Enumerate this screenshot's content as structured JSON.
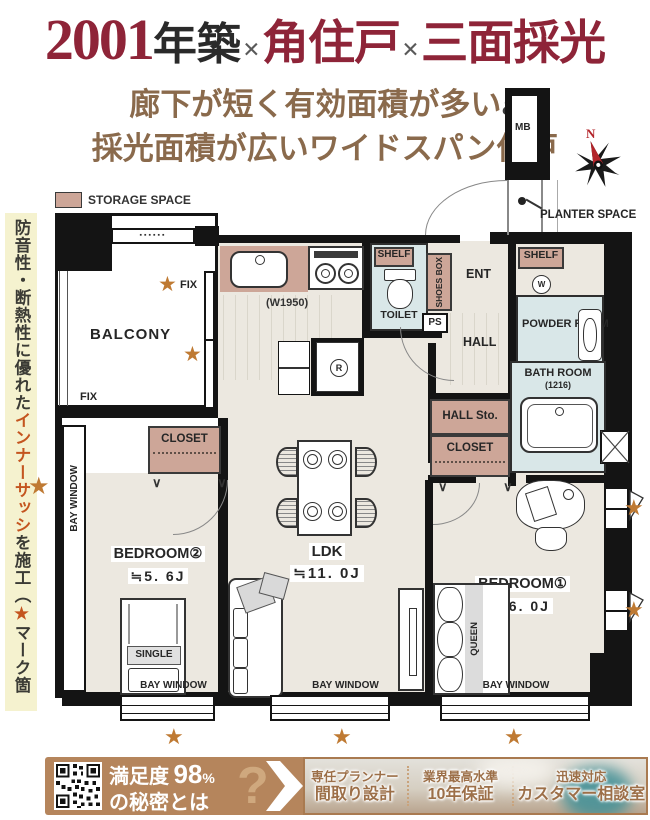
{
  "header": {
    "year": "2001",
    "built": "年築",
    "x1": "×",
    "corner_unit": "角住戸",
    "x2": "×",
    "three_sides": "三面採光"
  },
  "subtitle": {
    "line1": "廊下が短く有効面積が多い",
    "amp": "&",
    "line2": "採光面積が広いワイドスパン住戸"
  },
  "side_note": {
    "part1": "防音性・断熱性に優れた",
    "highlight": "インナーサッシ",
    "part2": "を施工（",
    "star": "★",
    "part3": "マーク箇所）"
  },
  "legend": {
    "storage_space": "STORAGE SPACE"
  },
  "compass": {
    "north": "N"
  },
  "plan": {
    "balcony": "BALCONY",
    "fix": "FIX",
    "bay_window": "BAY WINDOW",
    "closet": "CLOSET",
    "hall_sto": "HALL Sto.",
    "shelf": "SHELF",
    "shoes_box": "SHOES BOX",
    "toilet": "TOILET",
    "ps": "PS",
    "ent": "ENT",
    "hall": "HALL",
    "powder_room": "POWDER ROOM",
    "bath_room": "BATH ROOM",
    "bath_size": "(1216)",
    "ldk": "LDK",
    "ldk_size": "≒11. 0J",
    "bedroom1": "BEDROOM①",
    "bedroom1_size": "≒6. 0J",
    "bedroom2": "BEDROOM②",
    "bedroom2_size": "≒5. 6J",
    "single": "SINGLE",
    "queen": "QUEEN",
    "kitchen_width": "(W1950)",
    "fridge_r": "R",
    "washer_w": "W",
    "mb": "MB",
    "planter_space": "PLANTER SPACE",
    "star": "★",
    "v_mark": "∨ ∨"
  },
  "banner": {
    "prefix": "満足度",
    "number": "98",
    "percent": "%",
    "line2": "の秘密とは",
    "question": "?",
    "f1_top": "専任プランナー",
    "f1_bottom": "間取り設計",
    "f2_top": "業界最高水準",
    "f2_bottom": "10年保証",
    "f3_top": "迅速対応",
    "f3_bottom": "カスタマー相談室"
  },
  "colors": {
    "accent_red": "#8e2438",
    "subtitle_brown": "#8a6a4c",
    "note_bg": "#f5f2cf",
    "note_orange": "#c4551f",
    "storage_tan": "#cda698",
    "wet_blue": "#d9e7e8",
    "floor_beige": "#ece8e0",
    "star_orange": "#bf7a33",
    "banner_brown": "#b5855c",
    "banner_text_brown": "#9c6f48",
    "wall_black": "#141414"
  }
}
